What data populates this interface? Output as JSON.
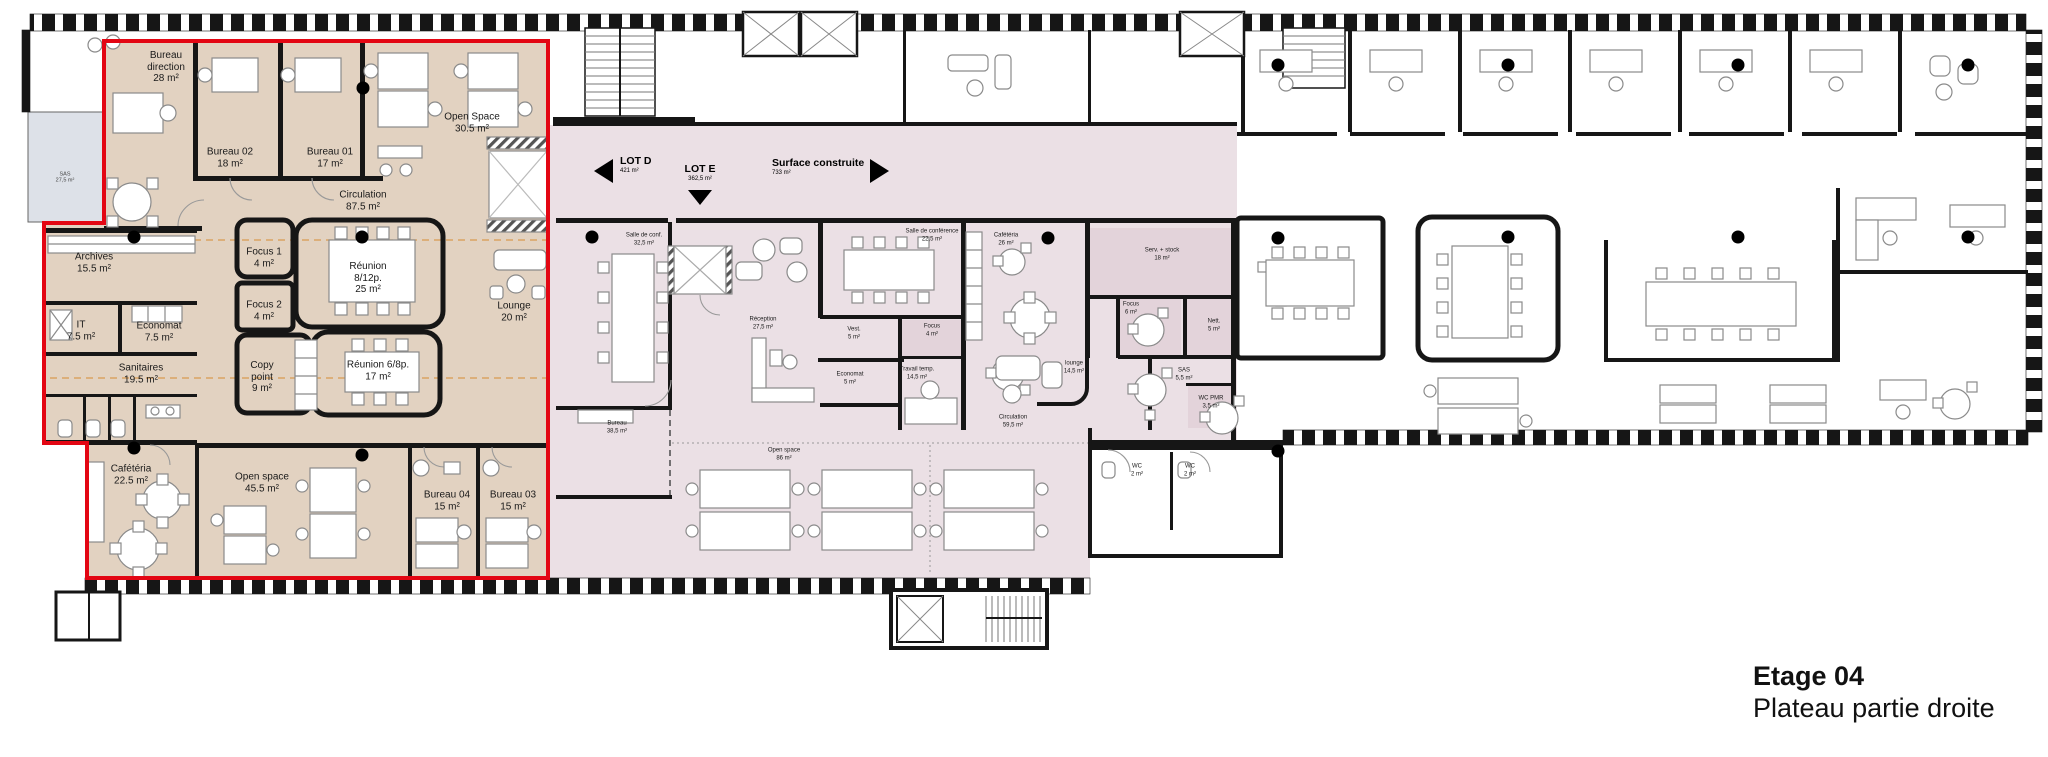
{
  "title": {
    "floor": "Etage 04",
    "subtitle": "Plateau partie droite"
  },
  "markers": [
    {
      "label": "LOT D",
      "area": "421 m²",
      "arrow": "left"
    },
    {
      "label": "LOT E",
      "area": "362,5 m²",
      "arrow": "down"
    },
    {
      "label": "Surface construite",
      "area": "733 m²",
      "arrow": "right"
    }
  ],
  "rooms": {
    "left": [
      {
        "name": "Bureau direction",
        "area": "28 m²"
      },
      {
        "name": "Bureau 02",
        "area": "18 m²"
      },
      {
        "name": "Bureau 01",
        "area": "17 m²"
      },
      {
        "name": "Open Space",
        "area": "30.5 m²"
      },
      {
        "name": "Circulation",
        "area": "87.5 m²"
      },
      {
        "name": "Archives",
        "area": "15.5 m²"
      },
      {
        "name": "Focus 1",
        "area": "4 m²"
      },
      {
        "name": "Réunion",
        "sub": "8/12p.",
        "area": "25 m²"
      },
      {
        "name": "Focus 2",
        "area": "4 m²"
      },
      {
        "name": "Lounge",
        "area": "20 m²"
      },
      {
        "name": "IT",
        "area": "7.5 m²"
      },
      {
        "name": "Economat",
        "area": "7.5 m²"
      },
      {
        "name": "Copy point",
        "area": "9 m²"
      },
      {
        "name": "Réunion 6/8p.",
        "area": "17 m²"
      },
      {
        "name": "Sanitaires",
        "area": "19.5 m²"
      },
      {
        "name": "Cafétéria",
        "area": "22.5 m²"
      },
      {
        "name": "Open space",
        "area": "45.5 m²"
      },
      {
        "name": "Bureau 04",
        "area": "15 m²"
      },
      {
        "name": "Bureau 03",
        "area": "15 m²"
      }
    ],
    "annex": [
      {
        "name": "SAS",
        "area": "27,5 m²"
      }
    ],
    "mid": [
      {
        "name": "Salle de conf.",
        "area": "32,5 m²"
      },
      {
        "name": "Salle de conférence",
        "area": "22,5 m²"
      },
      {
        "name": "Cafétéria",
        "area": "26 m²"
      },
      {
        "name": "Serv. + stock",
        "area": "18 m²"
      },
      {
        "name": "Réception",
        "area": "27,5 m²"
      },
      {
        "name": "Vest.",
        "area": "5 m²"
      },
      {
        "name": "Focus",
        "area": "4 m²"
      },
      {
        "name": "Economat",
        "area": "5 m²"
      },
      {
        "name": "Travail temp.",
        "area": "14,5 m²"
      },
      {
        "name": "Focus",
        "area": "6 m²"
      },
      {
        "name": "Nett.",
        "area": "5 m²"
      },
      {
        "name": "SAS",
        "area": "5,5 m²"
      },
      {
        "name": "WC PMR",
        "area": "3,5 m²"
      },
      {
        "name": "lounge",
        "area": "14,5 m²"
      },
      {
        "name": "Circulation",
        "area": "59,5 m²"
      },
      {
        "name": "Bureau",
        "area": "38,5 m²"
      },
      {
        "name": "Open space",
        "area": "86 m²"
      },
      {
        "name": "WC",
        "area": "2 m²"
      },
      {
        "name": "WC",
        "area": "2 m²"
      }
    ]
  },
  "colors": {
    "lot_outline_red": "#e30613",
    "zone_left_beige": "#e2d2c1",
    "zone_mid_pink": "#ebe0e5",
    "zone_mid_pink_dark": "#e3d3da",
    "annex_gray_blue": "#dde1e8",
    "wall_black": "#161616"
  }
}
